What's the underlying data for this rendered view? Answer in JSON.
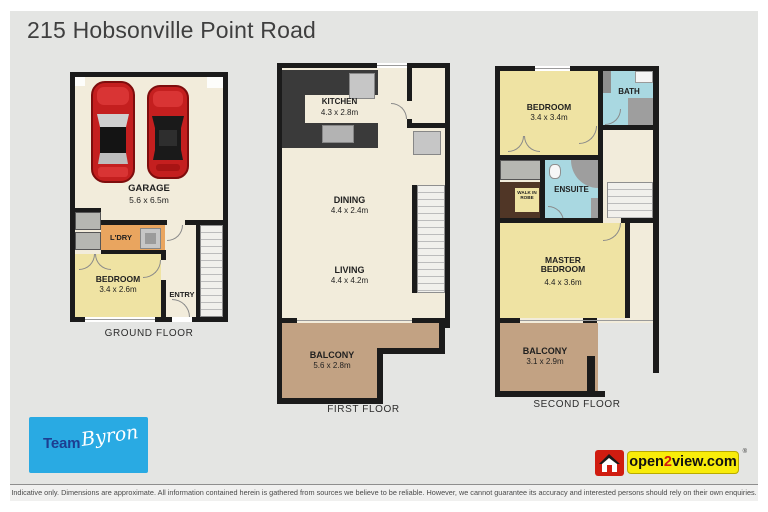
{
  "title": "215 Hobsonville Point Road",
  "floors": [
    {
      "label": "GROUND FLOOR",
      "rooms": [
        {
          "name": "GARAGE",
          "dims": "5.6 x 6.5m"
        },
        {
          "name": "L'DRY",
          "dims": ""
        },
        {
          "name": "BEDROOM",
          "dims": "3.4 x 2.6m"
        },
        {
          "name": "ENTRY",
          "dims": ""
        }
      ]
    },
    {
      "label": "FIRST FLOOR",
      "rooms": [
        {
          "name": "KITCHEN",
          "dims": "4.3 x 2.8m"
        },
        {
          "name": "DINING",
          "dims": "4.4 x 2.4m"
        },
        {
          "name": "LIVING",
          "dims": "4.4 x 4.2m"
        },
        {
          "name": "BALCONY",
          "dims": "5.6 x 2.8m"
        }
      ]
    },
    {
      "label": "SECOND FLOOR",
      "rooms": [
        {
          "name": "BEDROOM",
          "dims": "3.4 x 3.4m"
        },
        {
          "name": "BATH",
          "dims": ""
        },
        {
          "name": "WALK IN ROBE",
          "dims": ""
        },
        {
          "name": "ENSUITE",
          "dims": ""
        },
        {
          "name": "MASTER BEDROOM",
          "dims": "4.4 x 3.6m"
        },
        {
          "name": "BALCONY",
          "dims": "3.1 x 2.9m"
        }
      ]
    }
  ],
  "branding": {
    "agent": {
      "prefix": "Team",
      "script": "Byron"
    },
    "provider": {
      "pre": "open",
      "two": "2",
      "post": "view.com",
      "reg": "®"
    }
  },
  "footer": {
    "disclaimer": "Indicative only. Dimensions are approximate. All information contained herein is gathered from sources we believe to be reliable. However, we cannot guarantee its accuracy and interested persons should rely on their own enquiries."
  },
  "colors": {
    "wall": "#1b1b1b",
    "floor_cream": "#f2ecdb",
    "room_yellow": "#efe3a3",
    "balcony_tan": "#c2a283",
    "wet_area_blue": "#a9d8e1",
    "laundry_orange": "#e9a55f",
    "robe_brown": "#503626",
    "kitchen_counter": "#3a3a3a",
    "car_red": "#c41f1f",
    "team_blue": "#29aae3",
    "open2view_yellow": "#f8ec0a",
    "open2view_red": "#d01c10"
  }
}
